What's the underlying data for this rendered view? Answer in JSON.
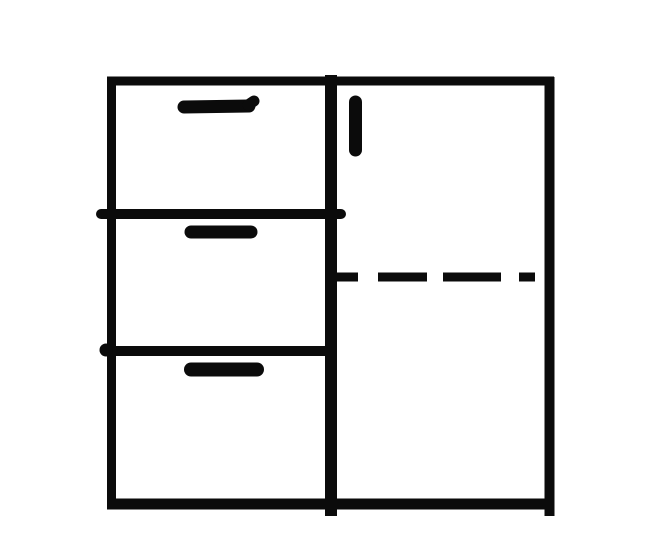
{
  "diagram": {
    "name": "cabinet-front-sketch",
    "description": "Hand-drawn black ink sketch of a cabinet front: three drawers with horizontal handles in the left column, a tall door with a vertical handle in the right column, and a horizontal dashed fold line across the door panel",
    "ink_color": "#0b0b0b",
    "background_color": "#ffffff",
    "canvas": {
      "width": 662,
      "height": 544
    },
    "strokes": [
      {
        "name": "frame-top-edge",
        "type": "line",
        "x1": 107,
        "y1": 81,
        "x2": 554,
        "y2": 81,
        "width": 9,
        "cap": "butt"
      },
      {
        "name": "frame-left-edge",
        "type": "line",
        "x1": 111.5,
        "y1": 77,
        "x2": 111.5,
        "y2": 509,
        "width": 9,
        "cap": "butt"
      },
      {
        "name": "frame-right-edge",
        "type": "line",
        "x1": 549.5,
        "y1": 77,
        "x2": 549.5,
        "y2": 516,
        "width": 10,
        "cap": "butt"
      },
      {
        "name": "frame-bottom-edge",
        "type": "line",
        "x1": 107,
        "y1": 504,
        "x2": 554,
        "y2": 504,
        "width": 11,
        "cap": "butt"
      },
      {
        "name": "center-divider",
        "type": "line",
        "x1": 331,
        "y1": 75,
        "x2": 331,
        "y2": 516,
        "width": 12,
        "cap": "butt"
      },
      {
        "name": "drawer-divider-1",
        "type": "line",
        "x1": 101,
        "y1": 214,
        "x2": 341,
        "y2": 214,
        "width": 10,
        "cap": "round"
      },
      {
        "name": "drawer-divider-2",
        "type": "line",
        "x1": 107,
        "y1": 351,
        "x2": 334,
        "y2": 351,
        "width": 10,
        "cap": "butt"
      },
      {
        "name": "drawer-divider-2-left-dot",
        "type": "dot",
        "cx": 106,
        "cy": 350,
        "r": 6.5
      },
      {
        "name": "drawer-1-handle",
        "type": "line",
        "x1": 184,
        "y1": 107,
        "x2": 249,
        "y2": 106,
        "width": 13,
        "cap": "round"
      },
      {
        "name": "drawer-1-handle-tip",
        "type": "line",
        "x1": 248,
        "y1": 105,
        "x2": 254,
        "y2": 101,
        "width": 11,
        "cap": "round"
      },
      {
        "name": "drawer-2-handle",
        "type": "line",
        "x1": 191,
        "y1": 232,
        "x2": 251,
        "y2": 232,
        "width": 13,
        "cap": "round"
      },
      {
        "name": "drawer-3-handle",
        "type": "line",
        "x1": 191,
        "y1": 369.5,
        "x2": 257,
        "y2": 369.5,
        "width": 14,
        "cap": "round"
      },
      {
        "name": "door-handle",
        "type": "line",
        "x1": 355.5,
        "y1": 102,
        "x2": 355.5,
        "y2": 150,
        "width": 13,
        "cap": "round"
      },
      {
        "name": "door-dash-segment-1",
        "type": "line",
        "x1": 337,
        "y1": 277,
        "x2": 358,
        "y2": 277,
        "width": 9,
        "cap": "butt"
      },
      {
        "name": "door-dash-segment-2",
        "type": "line",
        "x1": 378,
        "y1": 277,
        "x2": 427,
        "y2": 277,
        "width": 9,
        "cap": "butt"
      },
      {
        "name": "door-dash-segment-3",
        "type": "line",
        "x1": 443,
        "y1": 277,
        "x2": 501,
        "y2": 277,
        "width": 9,
        "cap": "butt"
      },
      {
        "name": "door-dash-segment-4",
        "type": "line",
        "x1": 519,
        "y1": 277,
        "x2": 535,
        "y2": 277,
        "width": 9,
        "cap": "butt"
      }
    ]
  }
}
